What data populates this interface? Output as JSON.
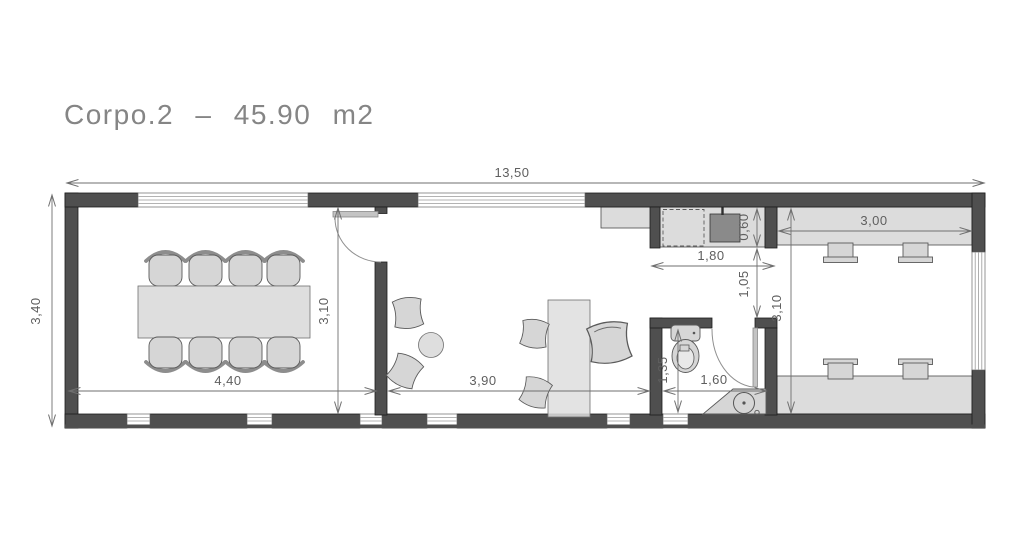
{
  "title": "Corpo.2 – 45.90 m2",
  "dimensions": {
    "overall_width": "13,50",
    "overall_depth": "3,40",
    "meeting_room_width": "4,40",
    "meeting_room_depth": "3,10",
    "office_width": "3,90",
    "kitchenette_width": "1,80",
    "kitchenette_depth": "0,60",
    "passage_width": "1,05",
    "bathroom_depth": "1,35",
    "bathroom_width": "1,60",
    "studio_width": "3,00",
    "studio_depth": "3,10"
  },
  "colors": {
    "wall": "#4f4f4f",
    "furniture": "#d6d6d6",
    "counter": "#dcdcdc",
    "dimension_line": "#6f6f6f",
    "title_text": "#858585",
    "sink": "#8a8a8a",
    "background": "#ffffff"
  }
}
